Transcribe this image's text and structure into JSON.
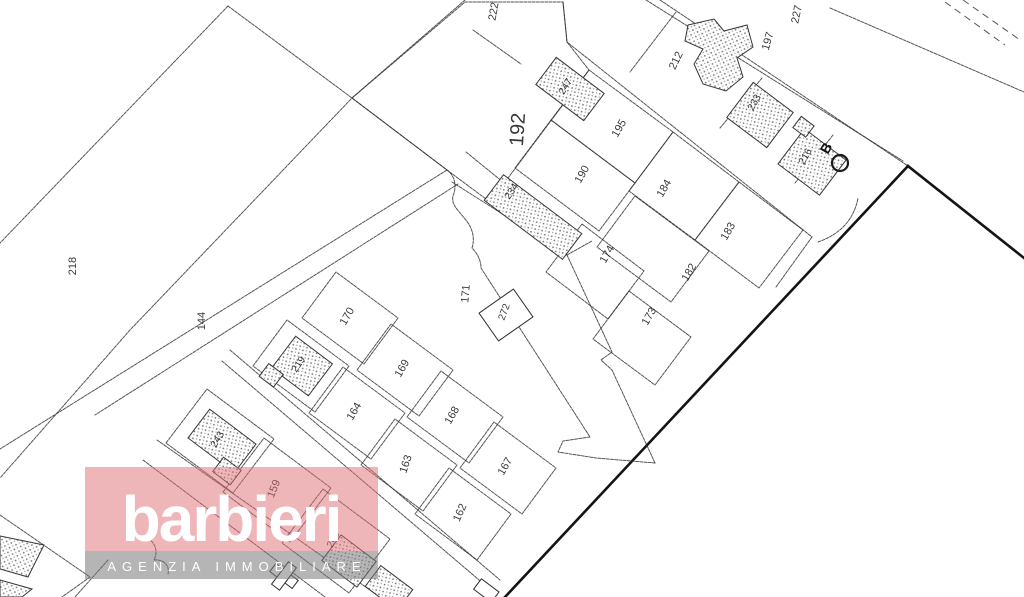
{
  "map": {
    "description": "cadastral-parcel-map",
    "parcel_labels": [
      {
        "text": "218",
        "x": 76,
        "y": 266,
        "r": -90,
        "fs": 11
      },
      {
        "text": "144",
        "x": 205,
        "y": 321,
        "r": -90,
        "fs": 11
      },
      {
        "text": "222",
        "x": 497,
        "y": 12,
        "r": -80,
        "fs": 11
      },
      {
        "text": "192",
        "x": 524,
        "y": 130,
        "r": -86,
        "fs": 20
      },
      {
        "text": "247",
        "x": 568,
        "y": 88,
        "r": -58,
        "fs": 10
      },
      {
        "text": "195",
        "x": 622,
        "y": 130,
        "r": -60,
        "fs": 11
      },
      {
        "text": "190",
        "x": 585,
        "y": 176,
        "r": -60,
        "fs": 11
      },
      {
        "text": "184",
        "x": 667,
        "y": 190,
        "r": -60,
        "fs": 11
      },
      {
        "text": "183",
        "x": 731,
        "y": 233,
        "r": -60,
        "fs": 11
      },
      {
        "text": "182",
        "x": 692,
        "y": 274,
        "r": -60,
        "fs": 11
      },
      {
        "text": "174",
        "x": 610,
        "y": 256,
        "r": -60,
        "fs": 11
      },
      {
        "text": "173",
        "x": 652,
        "y": 318,
        "r": -60,
        "fs": 11
      },
      {
        "text": "234",
        "x": 514,
        "y": 193,
        "r": -56,
        "fs": 10
      },
      {
        "text": "171",
        "x": 469,
        "y": 294,
        "r": -85,
        "fs": 11
      },
      {
        "text": "272",
        "x": 507,
        "y": 313,
        "r": -70,
        "fs": 10
      },
      {
        "text": "212",
        "x": 679,
        "y": 62,
        "r": -64,
        "fs": 11
      },
      {
        "text": "233",
        "x": 757,
        "y": 104,
        "r": -60,
        "fs": 10
      },
      {
        "text": "216",
        "x": 808,
        "y": 158,
        "r": -60,
        "fs": 10
      },
      {
        "text": "197",
        "x": 771,
        "y": 42,
        "r": -74,
        "fs": 11
      },
      {
        "text": "227",
        "x": 800,
        "y": 15,
        "r": -78,
        "fs": 11
      },
      {
        "text": "170",
        "x": 350,
        "y": 318,
        "r": -60,
        "fs": 11
      },
      {
        "text": "219",
        "x": 301,
        "y": 366,
        "r": -56,
        "fs": 10
      },
      {
        "text": "169",
        "x": 405,
        "y": 370,
        "r": -60,
        "fs": 11
      },
      {
        "text": "164",
        "x": 357,
        "y": 413,
        "r": -60,
        "fs": 11
      },
      {
        "text": "168",
        "x": 455,
        "y": 417,
        "r": -60,
        "fs": 11
      },
      {
        "text": "163",
        "x": 409,
        "y": 465,
        "r": -72,
        "fs": 11
      },
      {
        "text": "167",
        "x": 508,
        "y": 468,
        "r": -60,
        "fs": 11
      },
      {
        "text": "162",
        "x": 463,
        "y": 514,
        "r": -66,
        "fs": 11
      },
      {
        "text": "243",
        "x": 220,
        "y": 441,
        "r": -58,
        "fs": 10
      },
      {
        "text": "159",
        "x": 277,
        "y": 490,
        "r": -68,
        "fs": 11
      },
      {
        "text": "249",
        "x": 336,
        "y": 541,
        "r": -62,
        "fs": 10
      }
    ],
    "marker": {
      "label": "B"
    },
    "line_color": "#2e2e2e",
    "background": "#ffffff"
  },
  "watermark": {
    "brand": "barbieri",
    "tagline": "AGENZIA IMMOBILIARE",
    "brand_band_color": "#dd6e71",
    "tagline_band_color": "#787878",
    "text_color": "#ffffff"
  }
}
